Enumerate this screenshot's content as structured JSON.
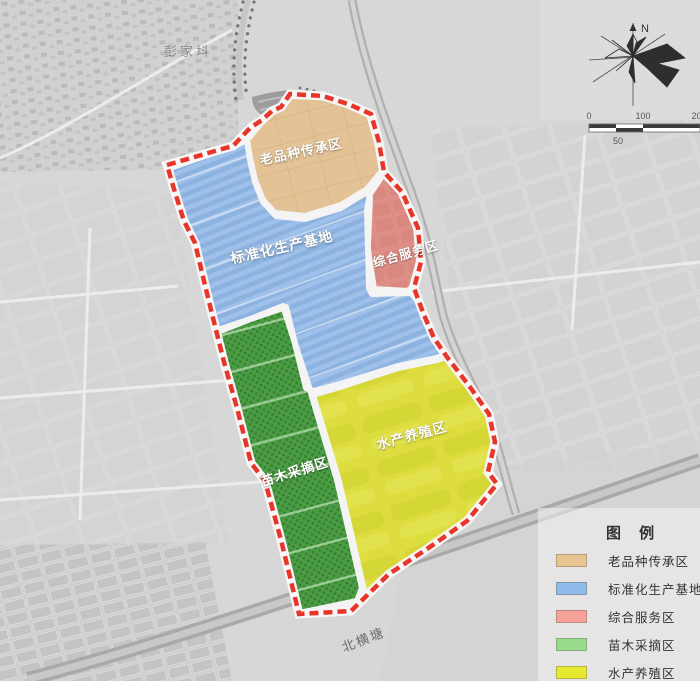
{
  "map": {
    "place_labels": [
      {
        "id": "village",
        "text": "彭家㘰"
      },
      {
        "id": "canal-road",
        "text": "北横塘"
      }
    ],
    "zones": [
      {
        "id": "heritage",
        "label": "老品种传承区",
        "map_color": "#e3c295"
      },
      {
        "id": "production",
        "label": "标准化生产基地",
        "map_color": "#8cb2e0"
      },
      {
        "id": "service",
        "label": "综合服务区",
        "map_color": "#dc8e86"
      },
      {
        "id": "nursery",
        "label": "苗木采摘区",
        "map_color": "#4c9b45"
      },
      {
        "id": "aquaculture",
        "label": "水产养殖区",
        "map_color": "#dddd3f"
      }
    ],
    "boundary_color": "#e8352a"
  },
  "compass": {
    "north_label": "N"
  },
  "scale_bar": {
    "ticks": [
      "0",
      "100",
      "200"
    ],
    "sub_tick": "50"
  },
  "legend": {
    "title": "图 例",
    "items": [
      {
        "label": "老品种传承区",
        "color": "#e9c493"
      },
      {
        "label": "标准化生产基地",
        "color": "#90bbea"
      },
      {
        "label": "综合服务区",
        "color": "#f7a19b"
      },
      {
        "label": "苗木采摘区",
        "color": "#98dc8b"
      },
      {
        "label": "水产养殖区",
        "color": "#e6e930"
      }
    ]
  }
}
